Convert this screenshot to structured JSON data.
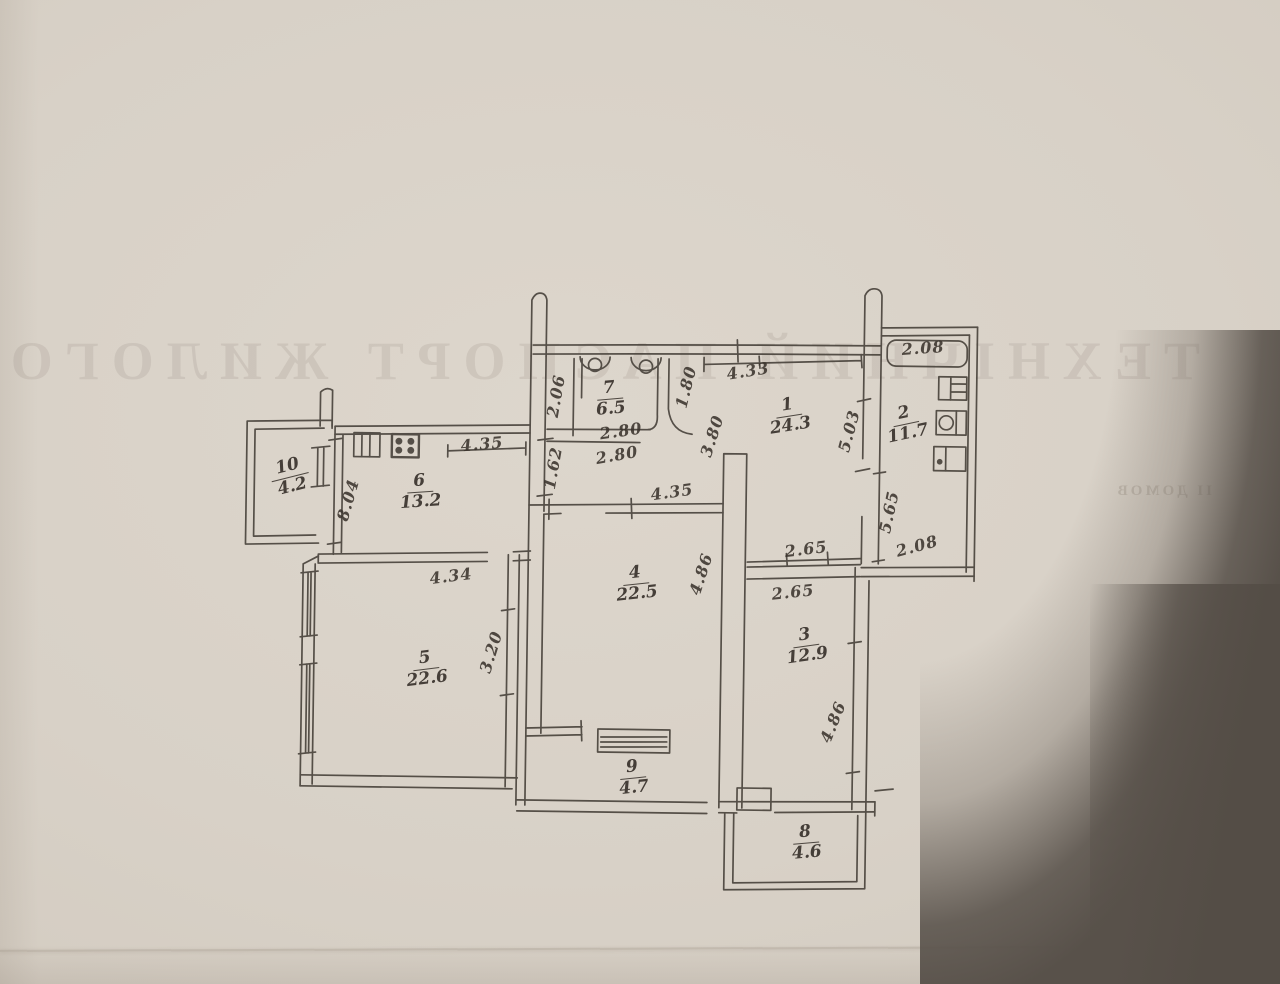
{
  "document": {
    "kind": "hand-drawn apartment floor plan sketch (technical passport page)",
    "paper_color": "#d9d2c8",
    "ink_color": "#48423b",
    "backdrop_color": "#58514a"
  },
  "bleed_through": {
    "line_large": "ТЕХНІЧНИЙ ПАСПОРТ ЖИЛОГО",
    "line_small": "ІІ ДОМОВ"
  },
  "floor_plan": {
    "rooms": [
      {
        "number": "7",
        "area": "6.5",
        "x": 610,
        "y": 399,
        "rot": -5
      },
      {
        "number": "1",
        "area": "24.3",
        "x": 789,
        "y": 416,
        "rot": -9
      },
      {
        "number": "2",
        "area": "11.7",
        "x": 906,
        "y": 424,
        "rot": -12
      },
      {
        "number": "6",
        "area": "13.2",
        "x": 420,
        "y": 492,
        "rot": -4
      },
      {
        "number": "10",
        "area": "4.2",
        "x": 290,
        "y": 477,
        "rot": -14
      },
      {
        "number": "4",
        "area": "22.5",
        "x": 636,
        "y": 584,
        "rot": -6
      },
      {
        "number": "3",
        "area": "12.9",
        "x": 806,
        "y": 646,
        "rot": -8
      },
      {
        "number": "5",
        "area": "22.6",
        "x": 426,
        "y": 669,
        "rot": -7
      },
      {
        "number": "9",
        "area": "4.7",
        "x": 633,
        "y": 778,
        "rot": -6
      },
      {
        "number": "8",
        "area": "4.6",
        "x": 806,
        "y": 843,
        "rot": -5
      }
    ],
    "dimensions": [
      {
        "text": "2.06",
        "x": 556,
        "y": 396,
        "rot": -80
      },
      {
        "text": "2.80",
        "x": 621,
        "y": 431,
        "rot": -8
      },
      {
        "text": "2.80",
        "x": 617,
        "y": 455,
        "rot": -10
      },
      {
        "text": "1.80",
        "x": 686,
        "y": 387,
        "rot": -76
      },
      {
        "text": "4.33",
        "x": 748,
        "y": 371,
        "rot": -9
      },
      {
        "text": "3.80",
        "x": 712,
        "y": 436,
        "rot": -72
      },
      {
        "text": "5.03",
        "x": 849,
        "y": 431,
        "rot": -75
      },
      {
        "text": "2.08",
        "x": 923,
        "y": 348,
        "rot": -4
      },
      {
        "text": "5.65",
        "x": 889,
        "y": 512,
        "rot": -78
      },
      {
        "text": "2.08",
        "x": 917,
        "y": 546,
        "rot": -15
      },
      {
        "text": "1.62",
        "x": 553,
        "y": 468,
        "rot": -80
      },
      {
        "text": "4.35",
        "x": 482,
        "y": 444,
        "rot": -5
      },
      {
        "text": "8.04",
        "x": 348,
        "y": 500,
        "rot": -74
      },
      {
        "text": "4.35",
        "x": 672,
        "y": 492,
        "rot": -8
      },
      {
        "text": "4.86",
        "x": 701,
        "y": 574,
        "rot": -72
      },
      {
        "text": "2.65",
        "x": 806,
        "y": 549,
        "rot": -7
      },
      {
        "text": "2.65",
        "x": 793,
        "y": 592,
        "rot": -6
      },
      {
        "text": "4.86",
        "x": 833,
        "y": 722,
        "rot": -68
      },
      {
        "text": "4.34",
        "x": 451,
        "y": 576,
        "rot": -7
      },
      {
        "text": "3.20",
        "x": 491,
        "y": 652,
        "rot": -73
      }
    ],
    "fixtures": [
      "toilet-icon",
      "washbasin-icon",
      "kitchen-sink-icon",
      "kitchen-stove-icon",
      "stove-icon",
      "sink-icon",
      "appliance-icon",
      "wardrobe-icon",
      "window-icon",
      "loggia-window-icon",
      "balcony-door-icon"
    ]
  }
}
